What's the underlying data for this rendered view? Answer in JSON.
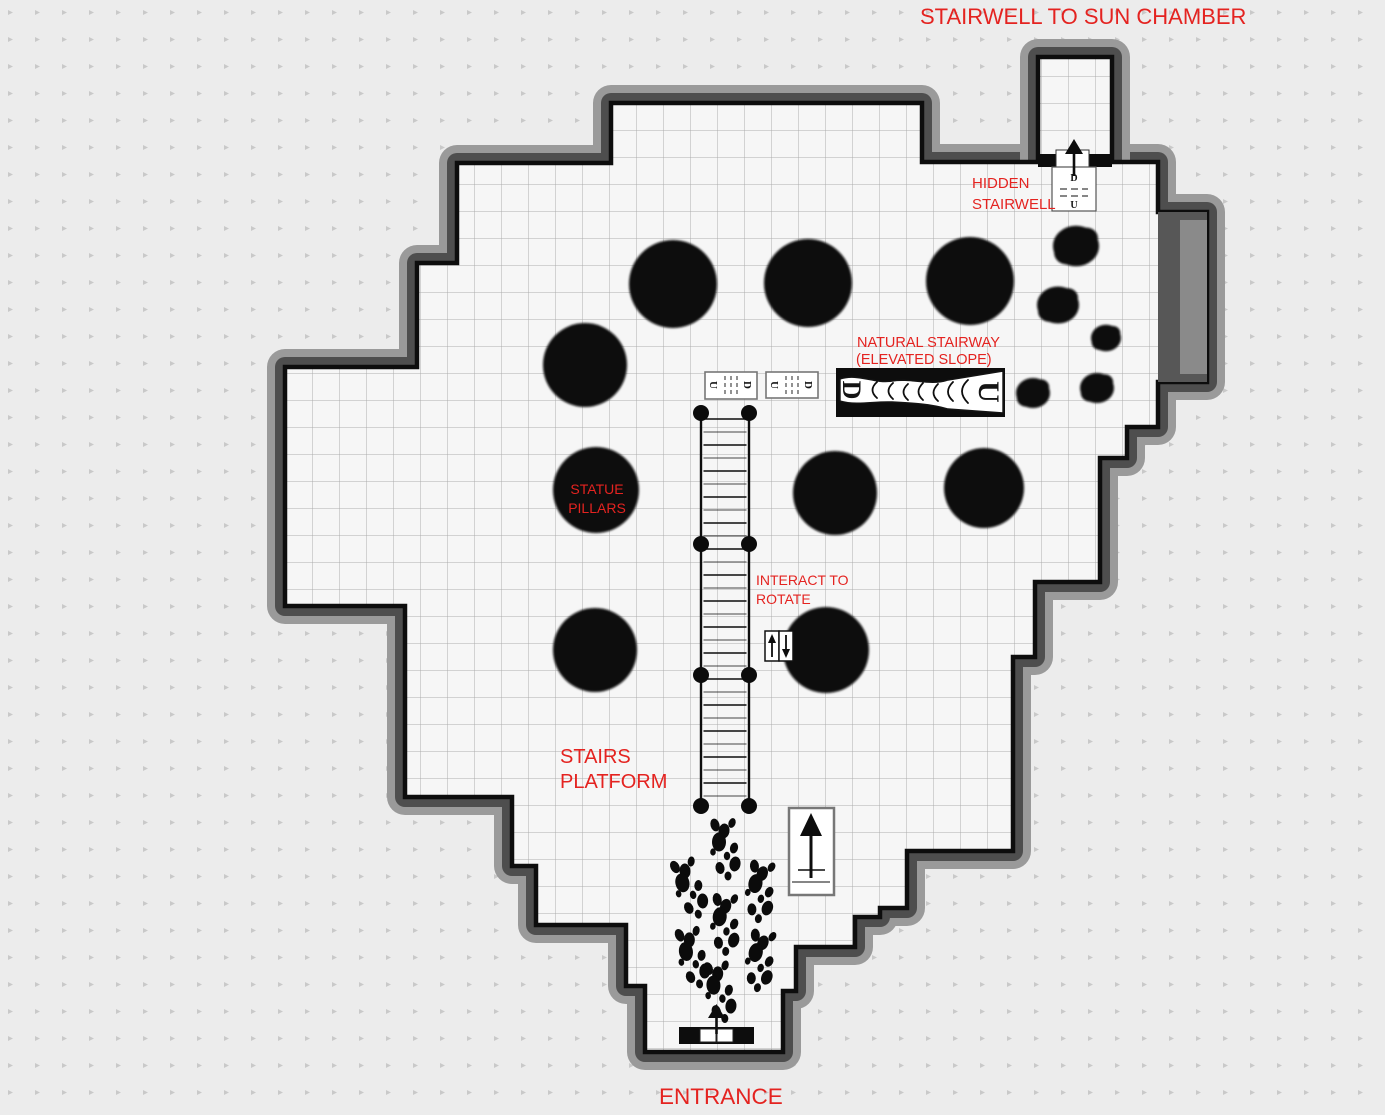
{
  "colors": {
    "background": "#ececec",
    "background_dot": "#c9c9c9",
    "floor": "#f6f6f6",
    "grid_line": "#adadad",
    "wall_line": "#0d0d0d",
    "wall_inner": "#4e4e4e",
    "wall_outer": "#9a9a9a",
    "pillar": "#0b0b0b",
    "label_red": "#e42320"
  },
  "labels": {
    "sun_chamber": "STAIRWELL TO SUN CHAMBER",
    "hidden_stairwell": {
      "line1": "HIDDEN",
      "line2": "STAIRWELL"
    },
    "natural_stairway": {
      "line1": "NATURAL STAIRWAY",
      "line2": "(ELEVATED SLOPE)"
    },
    "statue_pillars": {
      "line1": "STATUE",
      "line2": "PILLARS"
    },
    "interact_rotate": {
      "line1": "INTERACT TO",
      "line2": "ROTATE"
    },
    "stairs_platform": {
      "line1": "STAIRS",
      "line2": "PLATFORM"
    },
    "entrance": "ENTRANCE"
  },
  "glyphs": {
    "up": "U",
    "down": "D"
  },
  "map": {
    "grid_size": 27,
    "floor_outline": [
      [
        611,
        103
      ],
      [
        922,
        103
      ],
      [
        922,
        162
      ],
      [
        1158,
        162
      ],
      [
        1158,
        212
      ],
      [
        1207,
        212
      ],
      [
        1207,
        382
      ],
      [
        1158,
        382
      ],
      [
        1158,
        427
      ],
      [
        1127,
        427
      ],
      [
        1127,
        458
      ],
      [
        1100,
        458
      ],
      [
        1100,
        582
      ],
      [
        1035,
        582
      ],
      [
        1035,
        657
      ],
      [
        1013,
        657
      ],
      [
        1013,
        851
      ],
      [
        907,
        851
      ],
      [
        907,
        908
      ],
      [
        880,
        908
      ],
      [
        880,
        917
      ],
      [
        855,
        917
      ],
      [
        855,
        947
      ],
      [
        796,
        947
      ],
      [
        796,
        991
      ],
      [
        783,
        991
      ],
      [
        783,
        1052
      ],
      [
        645,
        1052
      ],
      [
        645,
        986
      ],
      [
        626,
        986
      ],
      [
        626,
        925
      ],
      [
        536,
        925
      ],
      [
        536,
        866
      ],
      [
        512,
        866
      ],
      [
        512,
        797
      ],
      [
        405,
        797
      ],
      [
        405,
        606
      ],
      [
        285,
        606
      ],
      [
        285,
        367
      ],
      [
        417,
        367
      ],
      [
        417,
        263
      ],
      [
        457,
        263
      ],
      [
        457,
        163
      ],
      [
        611,
        163
      ]
    ],
    "shaft_outline": [
      [
        1038,
        57
      ],
      [
        1112,
        57
      ],
      [
        1112,
        166
      ],
      [
        1038,
        166
      ]
    ],
    "pillars": [
      {
        "cx": 673,
        "cy": 284,
        "r": 44
      },
      {
        "cx": 808,
        "cy": 283,
        "r": 44
      },
      {
        "cx": 970,
        "cy": 281,
        "r": 44
      },
      {
        "cx": 585,
        "cy": 365,
        "r": 42
      },
      {
        "cx": 596,
        "cy": 490,
        "r": 43
      },
      {
        "cx": 835,
        "cy": 493,
        "r": 42
      },
      {
        "cx": 984,
        "cy": 488,
        "r": 40
      },
      {
        "cx": 595,
        "cy": 650,
        "r": 42
      },
      {
        "cx": 826,
        "cy": 650,
        "r": 43
      }
    ],
    "rocks": [
      {
        "cx": 1076,
        "cy": 246,
        "r": 23
      },
      {
        "cx": 1058,
        "cy": 305,
        "r": 21
      },
      {
        "cx": 1106,
        "cy": 338,
        "r": 15
      },
      {
        "cx": 1033,
        "cy": 393,
        "r": 17
      },
      {
        "cx": 1097,
        "cy": 388,
        "r": 17
      }
    ],
    "staircase": {
      "x_left": 701,
      "x_right": 749,
      "y_top": 413,
      "y_bottom": 806,
      "joints_y": [
        413,
        544,
        675,
        806
      ],
      "rung_step": 13
    },
    "track_trail": [
      {
        "x": 722,
        "y": 850,
        "rot": 0
      },
      {
        "x": 687,
        "y": 890,
        "rot": -12
      },
      {
        "x": 757,
        "y": 892,
        "rot": 10
      },
      {
        "x": 722,
        "y": 925,
        "rot": 5
      },
      {
        "x": 690,
        "y": 959,
        "rot": -8
      },
      {
        "x": 757,
        "y": 961,
        "rot": 12
      },
      {
        "x": 717,
        "y": 993,
        "rot": -4
      }
    ]
  }
}
